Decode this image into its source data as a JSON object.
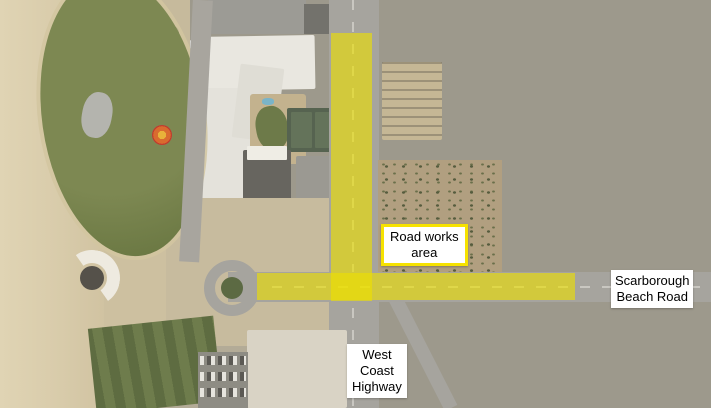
{
  "map": {
    "highlight_color": "#ede000",
    "labels": {
      "road_works": {
        "border_color": "#f6e200",
        "lines": [
          "Road works",
          "area"
        ]
      },
      "scarborough_beach_road": {
        "lines": [
          "Scarborough",
          "Beach Road"
        ]
      },
      "west_coast_highway": {
        "lines": [
          "West",
          "Coast",
          "Highway"
        ]
      }
    }
  }
}
